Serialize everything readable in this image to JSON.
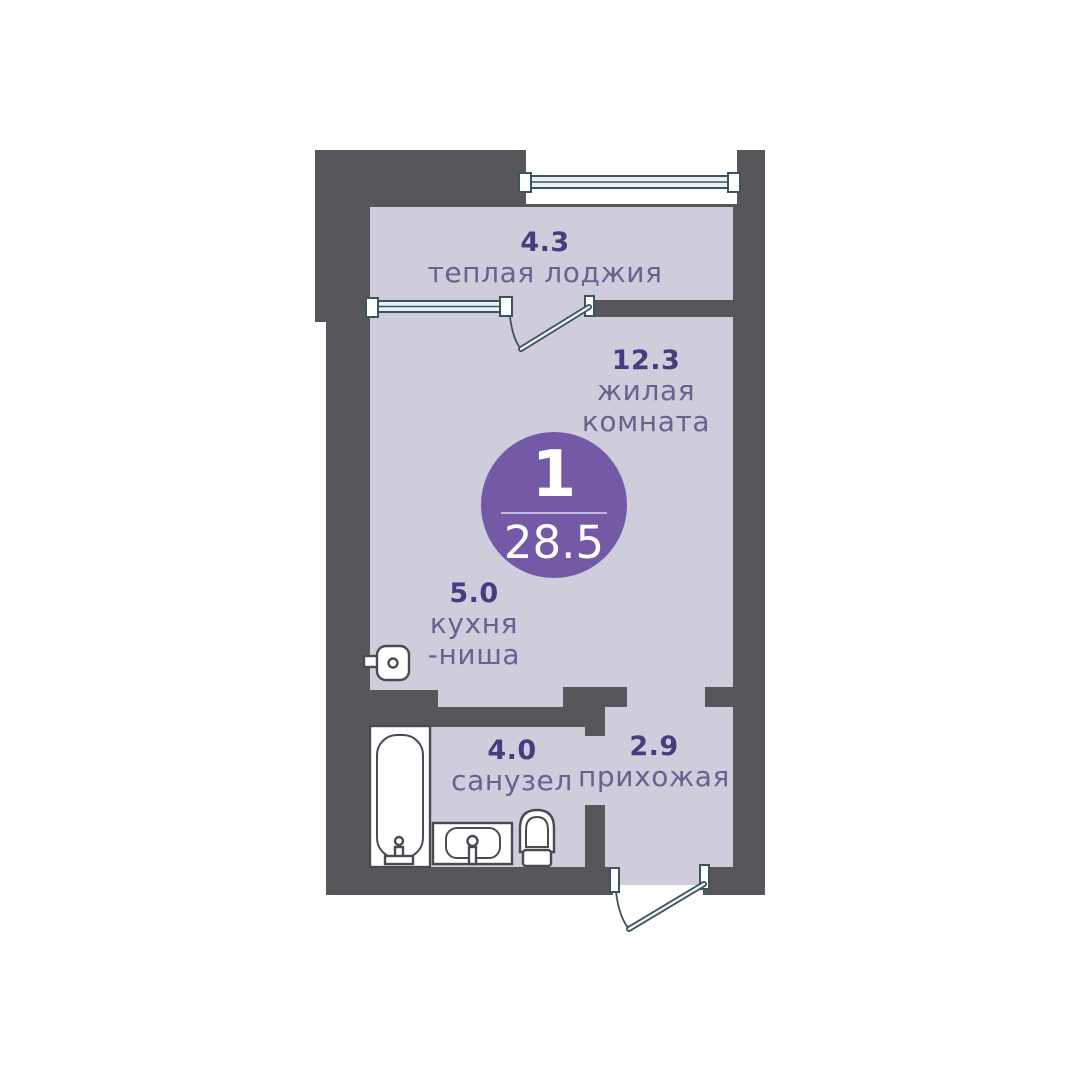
{
  "title": "Floor plan — 1-room apartment, 28.5 m²",
  "colors": {
    "wall": "#57575b",
    "floor": "#cfcddc",
    "accent": "#7459a6",
    "area-number": "#4a3a7f",
    "room-label": "#6a6191",
    "window-stroke": "#3c5460",
    "window-fill": "#e9f1f4",
    "fixture-stroke": "#484c52",
    "badge-divider": "#c3b6de"
  },
  "badge": {
    "room_count": "1",
    "total_area": "28.5"
  },
  "rooms": {
    "loggia": {
      "area": "4.3",
      "name": "теплая лоджия"
    },
    "living": {
      "area": "12.3",
      "name_line1": "жилая",
      "name_line2": "комната"
    },
    "kitchen": {
      "area": "5.0",
      "name_line1": "кухня",
      "name_line2": "-ниша"
    },
    "bathroom": {
      "area": "4.0",
      "name": "санузел"
    },
    "hallway": {
      "area": "2.9",
      "name": "прихожая"
    }
  },
  "plan": {
    "fixtures": [
      "bathtub-icon",
      "bathroom-sink-icon",
      "toilet-icon",
      "kitchen-sink-icon"
    ],
    "openings": [
      "top-window-icon",
      "loggia-window-icon",
      "loggia-door-swing-icon",
      "entry-door-swing-icon"
    ]
  }
}
